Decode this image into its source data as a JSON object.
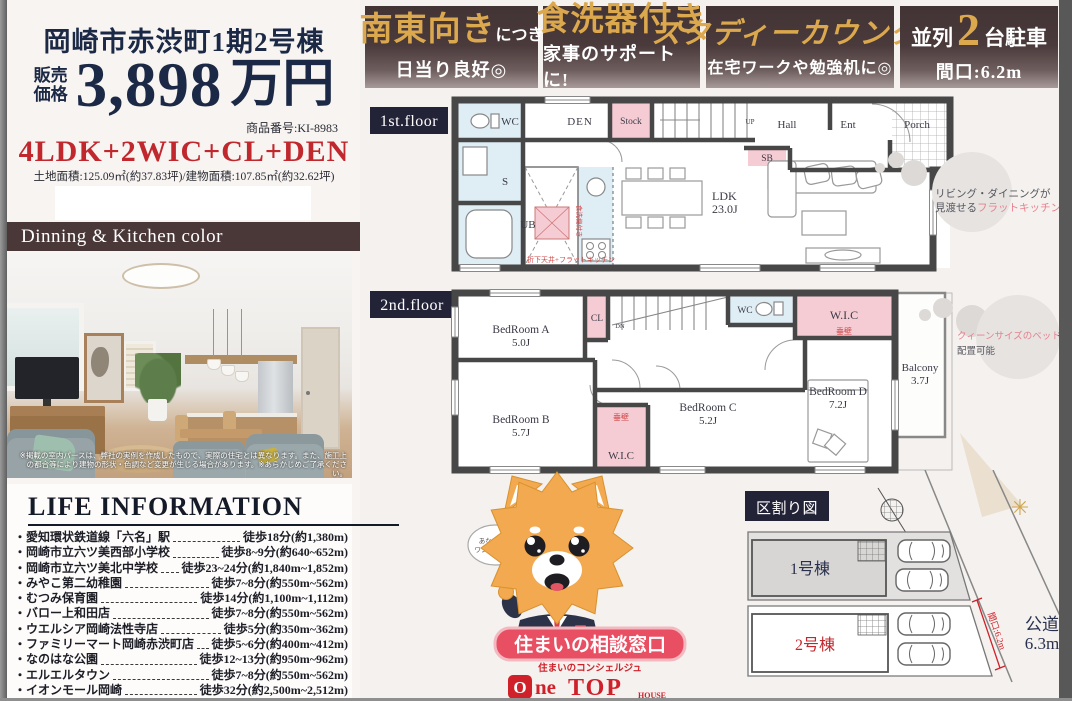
{
  "header": {
    "title": "岡崎市赤渋町1期2号棟",
    "price_label_1": "販売",
    "price_label_2": "価格",
    "price": "3,898",
    "price_unit": "万円",
    "product_no": "商品番号:KI-8983",
    "layout": "4LDK+2WIC+CL+DEN",
    "areas": "土地面積:125.09㎡(約37.83坪)/建物面積:107.85㎡(約32.62坪)"
  },
  "banners": [
    {
      "main": "南東向き",
      "main_suffix": "につき",
      "sub": "日当り良好◎"
    },
    {
      "main": "食洗器付き",
      "sub": "家事のサポートに!"
    },
    {
      "main": "スタディーカウンター",
      "sub": "在宅ワークや勉強机に◎"
    },
    {
      "pre": "並列",
      "num": "2",
      "post": "台駐車",
      "sub": "間口:6.2m"
    }
  ],
  "photo": {
    "band": "Dinning & Kitchen color",
    "caption": "※掲載の室内パースは、弊社の実例を作成したもので、実際の住宅とは異なります。また、施工上の都合等により建物の形状・色調など変更が生じる場合があります。※あらかじめご了承ください。"
  },
  "floor1": {
    "label": "1st.floor",
    "rooms": {
      "wc": "WC",
      "s": "S",
      "ub": "UB",
      "den": "DEN",
      "stock": "Stock",
      "up": "UP",
      "hall": "Hall",
      "sb": "SB",
      "ent": "Ent",
      "porch": "Porch",
      "ldk": "LDK",
      "ldk_size": "23.0J"
    },
    "notes": {
      "dishwasher": "食洗機付き",
      "ceiling": "折下天井+フラットキッチン"
    },
    "callout": {
      "line1": "リビング・ダイニングが",
      "line2": "見渡せる",
      "line2_accent": "フラットキッチン"
    }
  },
  "floor2": {
    "label": "2nd.floor",
    "rooms": {
      "a": "BedRoom A",
      "a_size": "5.0J",
      "b": "BedRoom B",
      "b_size": "5.7J",
      "c": "BedRoom C",
      "c_size": "5.2J",
      "d": "BedRoom D",
      "d_size": "7.2J",
      "cl": "CL",
      "dn": "DN",
      "wc": "WC",
      "wic_top": "W.I.C",
      "wic_bottom": "W.I.C",
      "tarekabe_top": "垂壁",
      "tarekabe_bottom": "垂壁",
      "balcony": "Balcony",
      "balcony_size": "3.7J"
    },
    "callout": {
      "accent": "クィーンサイズのベット",
      "suffix": "も",
      "line2": "配置可能"
    }
  },
  "life": {
    "title": "LIFE INFORMATION",
    "items": [
      {
        "name": "愛知環状鉄道線「六名」駅",
        "value": "徒歩18分(約1,380m)"
      },
      {
        "name": "岡崎市立六ツ美西部小学校",
        "value": "徒歩8~9分(約640~652m)"
      },
      {
        "name": "岡崎市立六ツ美北中学校",
        "value": "徒歩23~24分(約1,840m~1,852m)"
      },
      {
        "name": "みやこ第二幼稚園",
        "value": "徒歩7~8分(約550m~562m)"
      },
      {
        "name": "むつみ保育園",
        "value": "徒歩14分(約1,100m~1,112m)"
      },
      {
        "name": "バロー上和田店",
        "value": "徒歩7~8分(約550m~562m)"
      },
      {
        "name": "ウエルシア岡崎法性寺店",
        "value": "徒歩5分(約350m~362m)"
      },
      {
        "name": "ファミリーマート岡崎赤渋町店",
        "value": "徒歩5~6分(約400m~412m)"
      },
      {
        "name": "なのはな公園",
        "value": "徒歩12~13分(約950m~962m)"
      },
      {
        "name": "エルエルタウン",
        "value": "徒歩7~8分(約550m~562m)"
      },
      {
        "name": "イオンモール岡崎",
        "value": "徒歩32分(約2,500m~2,512m)"
      }
    ]
  },
  "mascot": {
    "bubble1": "あなたの、",
    "bubble2": "ワンストップ!",
    "banner": "住まいの相談窓口",
    "concierge": "住まいのコンシェルジュ",
    "logo_o": "O",
    "logo_ne": "ne",
    "logo_top": "TOP",
    "logo_house": "HOUSE"
  },
  "lot_map": {
    "label": "区割り図",
    "lot1": "1号棟",
    "lot2": "2号棟",
    "road": "公道",
    "road_width": "6.3m",
    "frontage": "間口:6.2m"
  },
  "colors": {
    "accent_red": "#c0282e",
    "gold": "#dba84e",
    "maroon": "#4a3738",
    "navy": "#1c2946",
    "pink": "#f6ccd4",
    "lightblue": "#dfeef5"
  }
}
